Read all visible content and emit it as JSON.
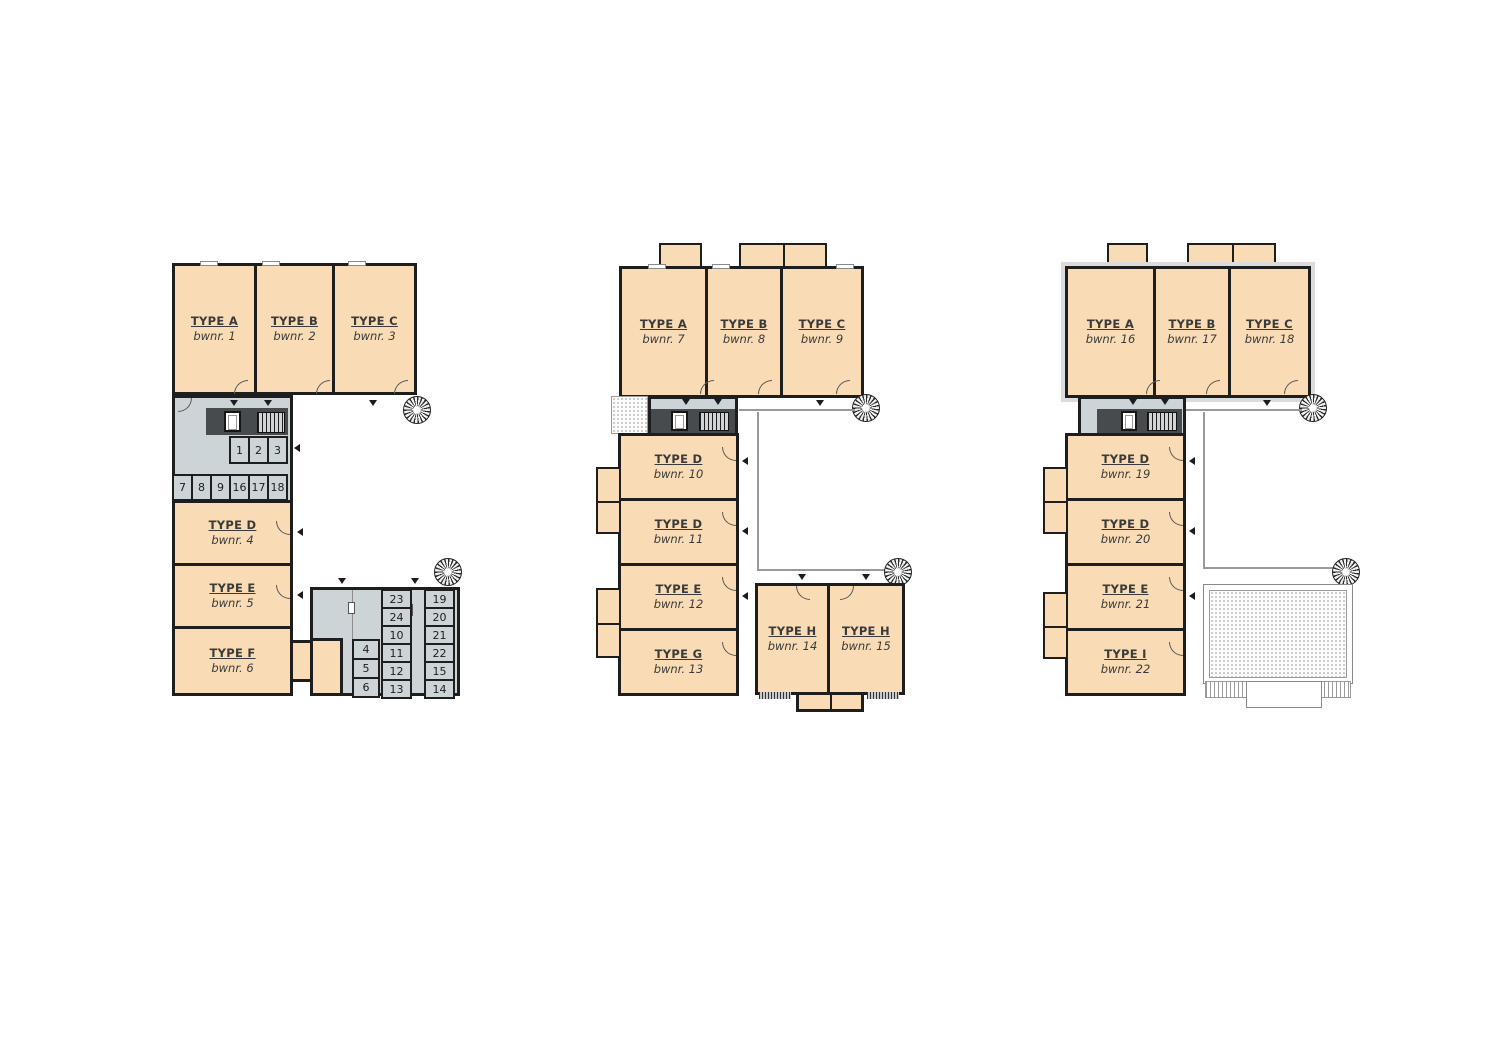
{
  "colors": {
    "room_fill": "#f9dcb5",
    "storage_fill": "#ccd4d7",
    "wall": "#1e1e1e",
    "core_fill": "#474b4d",
    "background": "#ffffff"
  },
  "plans": [
    {
      "label": "floor-plan-1",
      "rooms": [
        {
          "type": "TYPE A",
          "bwnr": "bwnr. 1"
        },
        {
          "type": "TYPE B",
          "bwnr": "bwnr. 2"
        },
        {
          "type": "TYPE C",
          "bwnr": "bwnr. 3"
        },
        {
          "type": "TYPE D",
          "bwnr": "bwnr. 4"
        },
        {
          "type": "TYPE E",
          "bwnr": "bwnr. 5"
        },
        {
          "type": "TYPE F",
          "bwnr": "bwnr. 6"
        }
      ],
      "cells_row1": [
        "1",
        "2",
        "3"
      ],
      "cells_row2": [
        "7",
        "8",
        "9",
        "16",
        "17",
        "18"
      ],
      "storage_col1": [
        "4",
        "5",
        "6"
      ],
      "storage_col2": [
        "23",
        "24",
        "10",
        "11",
        "12",
        "13"
      ],
      "storage_col3": [
        "19",
        "20",
        "21",
        "22",
        "15",
        "14"
      ]
    },
    {
      "label": "floor-plan-2",
      "rooms": [
        {
          "type": "TYPE A",
          "bwnr": "bwnr. 7"
        },
        {
          "type": "TYPE B",
          "bwnr": "bwnr. 8"
        },
        {
          "type": "TYPE C",
          "bwnr": "bwnr. 9"
        },
        {
          "type": "TYPE D",
          "bwnr": "bwnr. 10"
        },
        {
          "type": "TYPE D",
          "bwnr": "bwnr. 11"
        },
        {
          "type": "TYPE E",
          "bwnr": "bwnr. 12"
        },
        {
          "type": "TYPE G",
          "bwnr": "bwnr. 13"
        },
        {
          "type": "TYPE H",
          "bwnr": "bwnr. 14"
        },
        {
          "type": "TYPE H",
          "bwnr": "bwnr. 15"
        }
      ]
    },
    {
      "label": "floor-plan-3",
      "rooms": [
        {
          "type": "TYPE A",
          "bwnr": "bwnr. 16"
        },
        {
          "type": "TYPE B",
          "bwnr": "bwnr. 17"
        },
        {
          "type": "TYPE C",
          "bwnr": "bwnr. 18"
        },
        {
          "type": "TYPE D",
          "bwnr": "bwnr. 19"
        },
        {
          "type": "TYPE D",
          "bwnr": "bwnr. 20"
        },
        {
          "type": "TYPE E",
          "bwnr": "bwnr. 21"
        },
        {
          "type": "TYPE I",
          "bwnr": "bwnr. 22"
        }
      ]
    }
  ]
}
